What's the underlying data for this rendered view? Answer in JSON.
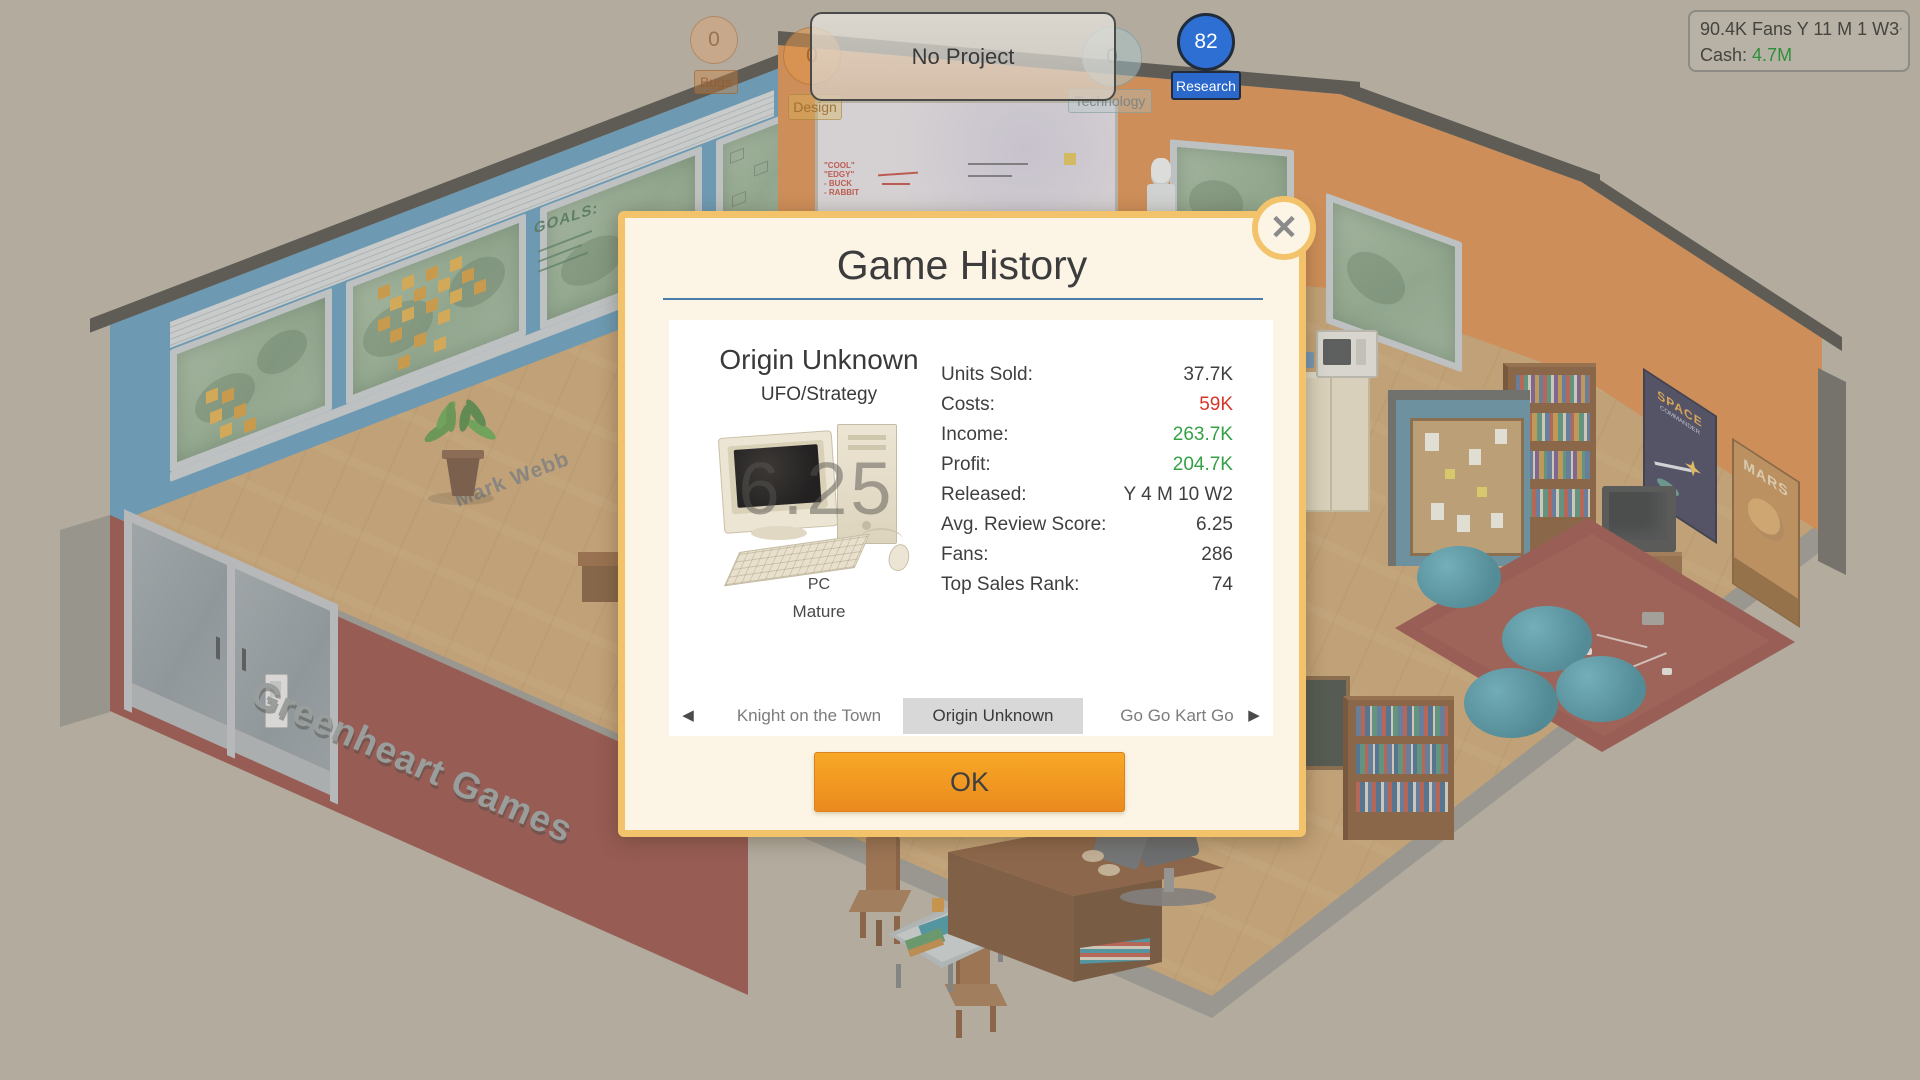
{
  "hud": {
    "project_banner": "No Project",
    "bubbles": {
      "bugs": {
        "label": "Bugs",
        "value": "0"
      },
      "design": {
        "label": "Design",
        "value": "0"
      },
      "technology": {
        "label": "Technology",
        "value": "0"
      },
      "research": {
        "label": "Research",
        "value": "82"
      }
    },
    "info_box": {
      "fans_line": "90.4K Fans Y 11 M 1 W3",
      "fans_sup": "·",
      "cash_label": "Cash:",
      "cash_value": "4.7M"
    }
  },
  "dialog": {
    "title": "Game History",
    "close_icon": "✕",
    "game": {
      "name": "Origin Unknown",
      "genre": "UFO/Strategy",
      "score_overlay": "6.25",
      "platform": "PC",
      "rating": "Mature"
    },
    "stats": [
      {
        "label": "Units Sold:",
        "value": "37.7K",
        "color": "#3f3f3f"
      },
      {
        "label": "Costs:",
        "value": "59K",
        "color": "#d9352a"
      },
      {
        "label": "Income:",
        "value": "263.7K",
        "color": "#35a046"
      },
      {
        "label": "Profit:",
        "value": "204.7K",
        "color": "#35a046"
      },
      {
        "label": "Released:",
        "value": "Y 4 M 10 W2",
        "color": "#3f3f3f"
      },
      {
        "label": "Avg. Review Score:",
        "value": "6.25",
        "color": "#3f3f3f"
      },
      {
        "label": "Fans:",
        "value": "286",
        "color": "#3f3f3f"
      },
      {
        "label": "Top Sales Rank:",
        "value": "74",
        "color": "#3f3f3f"
      }
    ],
    "nav": {
      "prev_icon": "◀",
      "next_icon": "▶",
      "items": [
        "Knight on the Town",
        "Origin Unknown",
        "Go Go Kart Go"
      ],
      "selected_index": 1
    },
    "ok_label": "OK"
  },
  "scene": {
    "company_sign": "Greenheart Games",
    "employee_name": "Mark Webb",
    "goals_text": "GOALS:",
    "poster_space_line1": "SPACE",
    "poster_space_line2": "COMMANDER",
    "poster_mars": "MARS"
  },
  "colors": {
    "dialog_border": "#f2c36b",
    "dialog_bg": "#fcf5e6",
    "ok_gradient_top": "#f7a826",
    "ok_gradient_bottom": "#eb8a1e",
    "research_blue": "#2d6fd2",
    "cost_red": "#d9352a",
    "money_green": "#35a046",
    "selected_tab_bg": "#d8d8d8"
  }
}
